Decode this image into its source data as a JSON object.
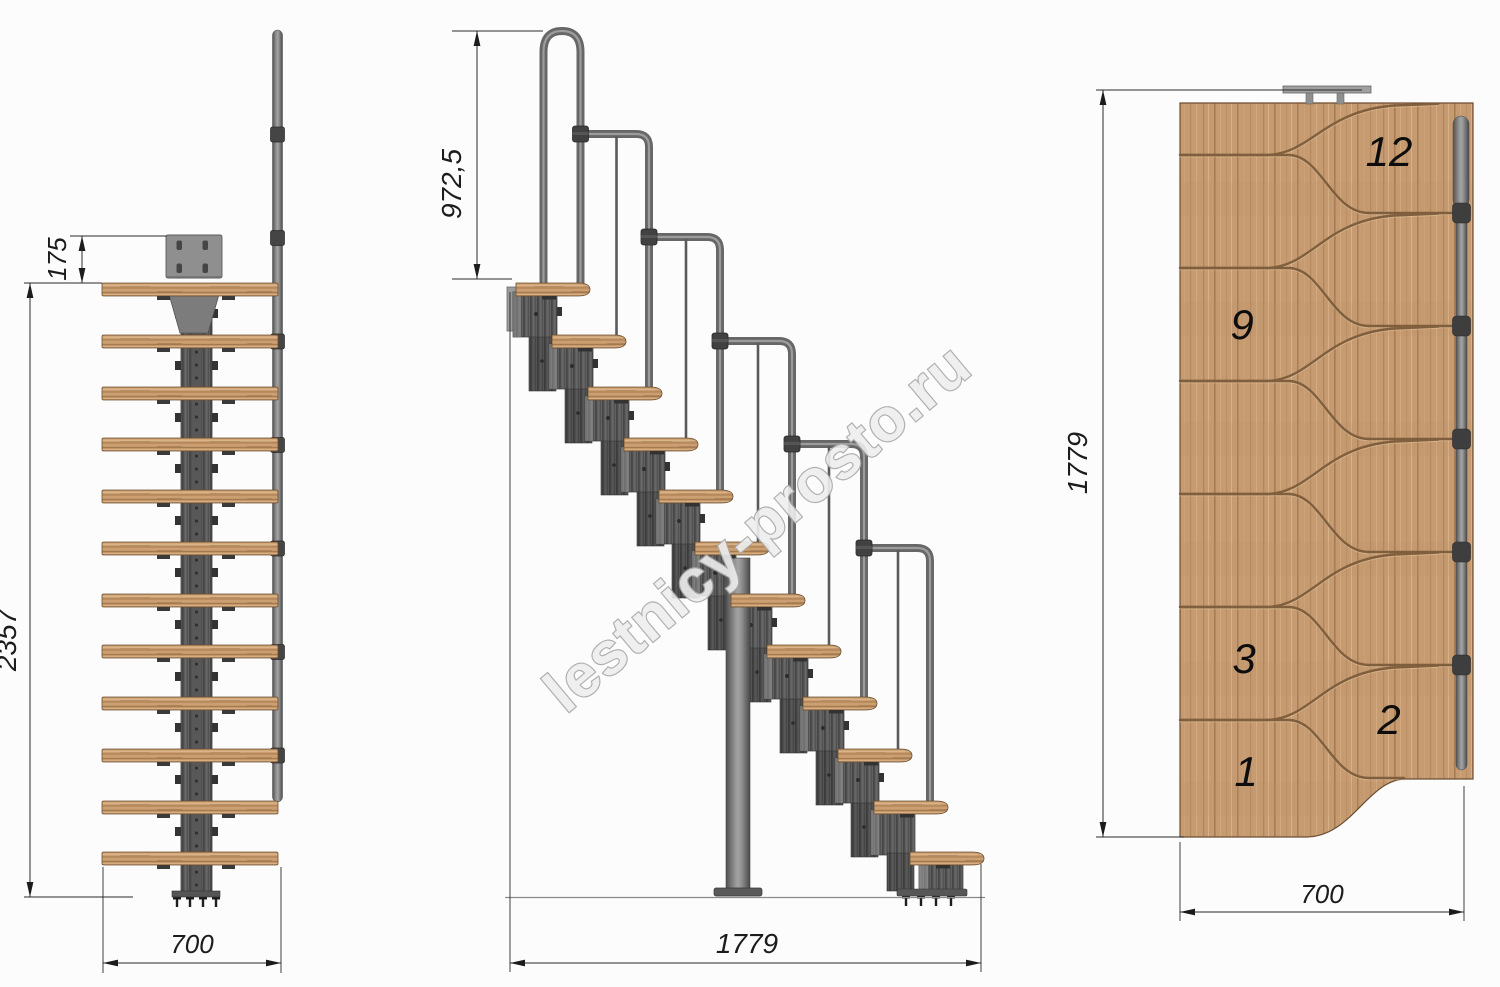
{
  "watermark": {
    "text": "lestnicy-prosto.ru",
    "color": "#eeeeee",
    "outline": "#a8a8a8"
  },
  "views": {
    "front": {
      "steps_count": 12,
      "dims": {
        "bracket_offset": "175",
        "total_height": "2357",
        "width": "700"
      }
    },
    "side": {
      "steps_count": 12,
      "dims": {
        "handrail_height": "972,5",
        "total_length": "1779"
      }
    },
    "plan": {
      "dims": {
        "total_length": "1779",
        "width": "700"
      },
      "step_numbers": [
        "12",
        "9",
        "3",
        "2",
        "1"
      ]
    }
  },
  "colors": {
    "background": "#fcfcfc",
    "wood": "#c79b71",
    "wood_groove": "#7a5a3a",
    "metal_dark": "#4c4c4c",
    "metal_mid": "#6b6b6b",
    "metal_light": "#9d9d9d",
    "dimension_line": "#2a2a2a",
    "text": "#1c1c1c"
  }
}
